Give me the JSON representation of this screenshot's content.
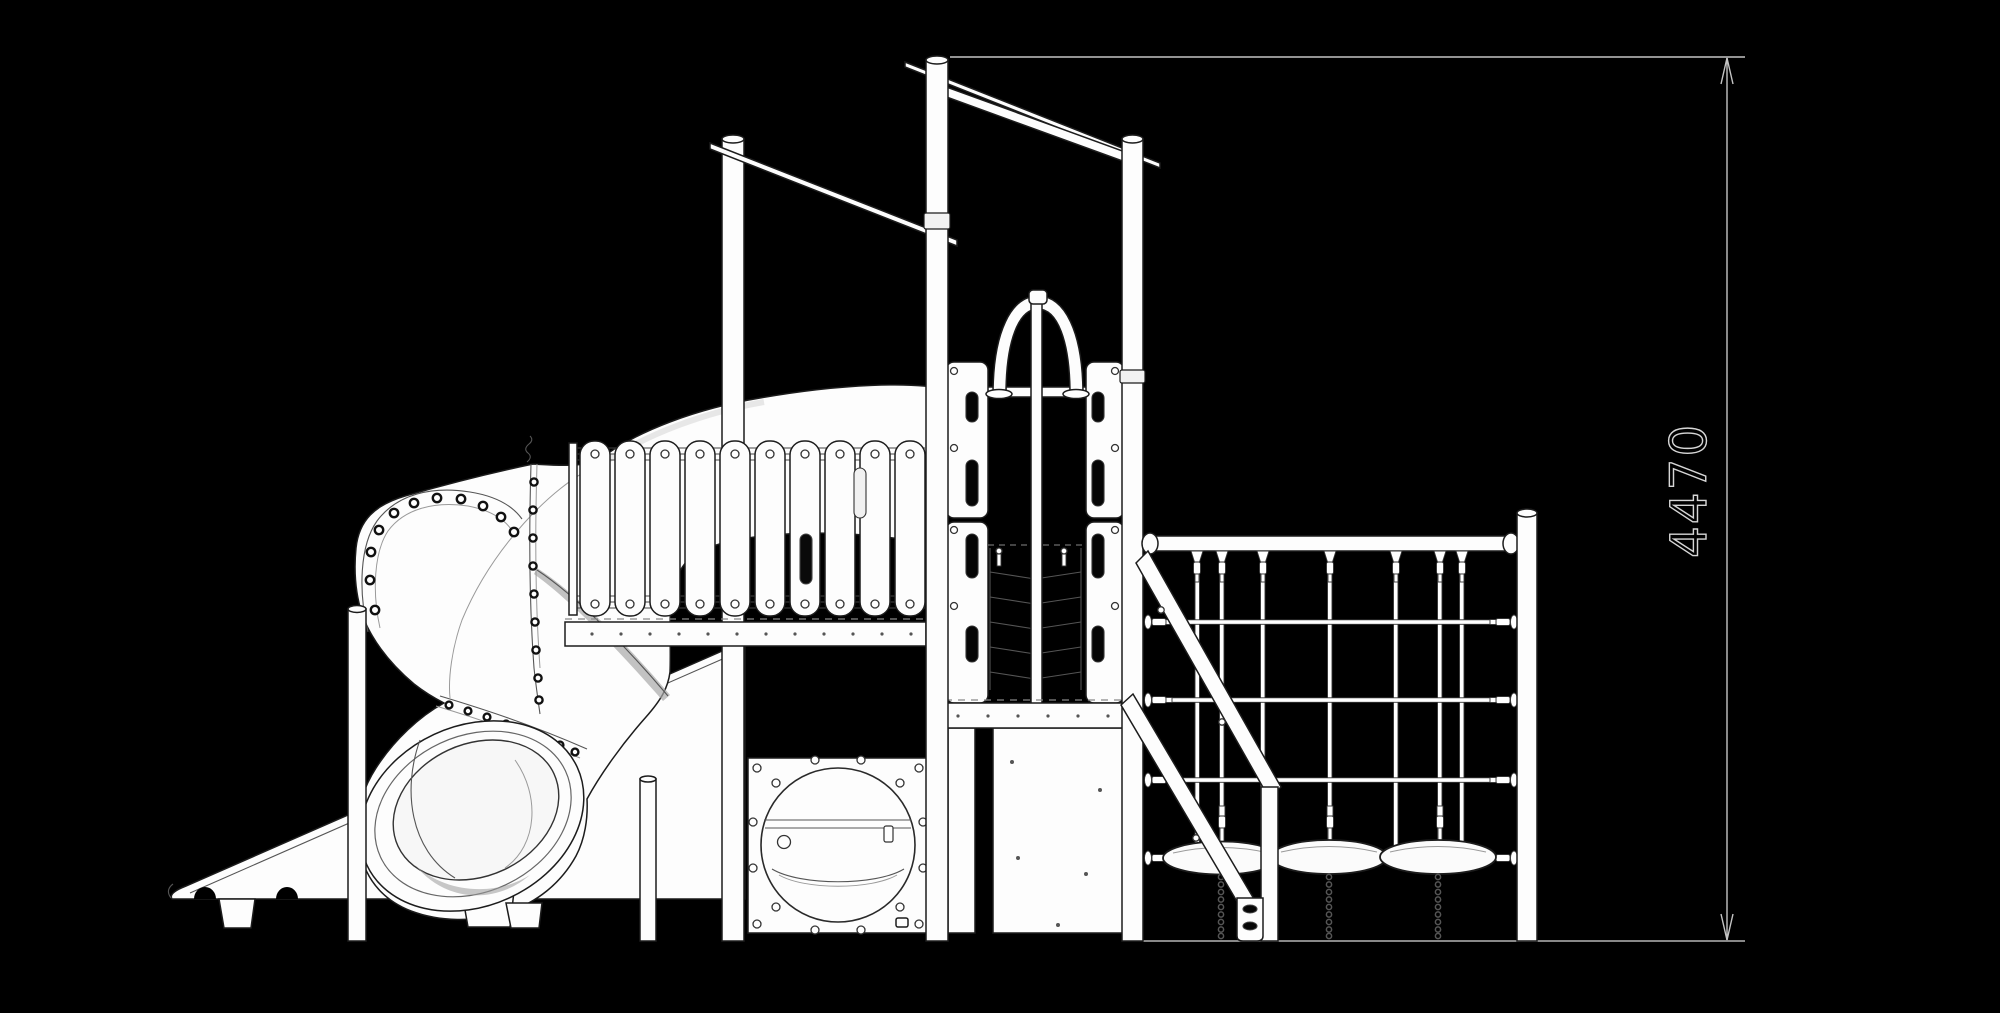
{
  "canvas": {
    "width": 2000,
    "height": 1013,
    "background_color": "#000000"
  },
  "line_art": {
    "outline_color": "#1c1c1c",
    "fill_color": "#fdfdfd",
    "detail_color": "#777777",
    "shade_color": "#9a9a9a"
  },
  "dimension_annotation": {
    "label": "4470",
    "orientation": "vertical",
    "line_color": "#c4c4c4",
    "text_fill": "#000000",
    "text_outline_color": "#d6d6d6",
    "ground_line_color": "#b5b5b5"
  }
}
